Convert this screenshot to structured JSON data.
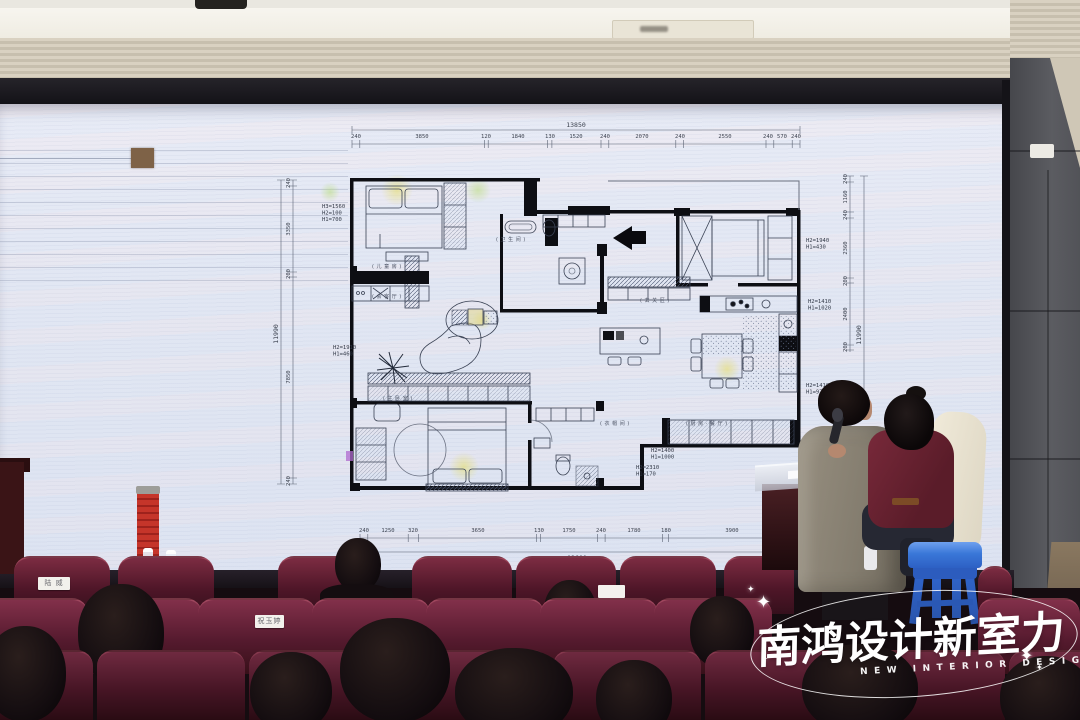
{
  "watermark": {
    "title": "南鸿设计新室力",
    "subtitle": "NEW INTERIOR DESIGN",
    "sparkle": "✦"
  },
  "floor_plan": {
    "top": {
      "total": "13850",
      "segments": [
        "240",
        "3850",
        "120",
        "1840",
        "130",
        "1520",
        "240",
        "2070",
        "240",
        "2550",
        "240",
        "570",
        "240"
      ]
    },
    "bottom": {
      "total": "13600",
      "segments": [
        "240",
        "1250",
        "320",
        "3650",
        "130",
        "1750",
        "240",
        "1780",
        "180",
        "3900"
      ]
    },
    "left": {
      "total": "11990",
      "segments": [
        "240",
        "3350",
        "200",
        "7850",
        "240"
      ]
    },
    "right": {
      "total": "11990",
      "segments": [
        "240",
        "1160",
        "240",
        "2360",
        "200",
        "2400",
        "200"
      ]
    },
    "height_labels": [
      {
        "lines": [
          "H3=1560",
          "H2=100",
          "H1=700"
        ]
      },
      {
        "lines": [
          "H2=1910",
          "H1=460"
        ]
      },
      {
        "lines": [
          "H2=1940",
          "H1=430"
        ]
      },
      {
        "lines": [
          "H2=1410",
          "H1=1020"
        ]
      },
      {
        "lines": [
          "H2=1410",
          "H1=970"
        ]
      },
      {
        "lines": [
          "H2=1400",
          "H1=1000"
        ]
      },
      {
        "lines": [
          "H2=2310",
          "H1=170"
        ]
      }
    ],
    "room_labels": [
      "( 儿 童 房 )",
      "( 会 客 厅 )",
      "( 主 卧 室 )",
      "( 玄 关 区 )",
      "( 衣 帽 间 )",
      "( 厨 房 · 餐 厅 )",
      "( 卫 生 间 )"
    ]
  },
  "audience": {
    "seat_tags": [
      "陆 威",
      "祝玉婷",
      ""
    ]
  },
  "colors": {
    "banner_red": "#c23227",
    "stool_blue": "#3273dc",
    "seat_maroon": "#6d2538",
    "logo_white": "#ffffff"
  }
}
